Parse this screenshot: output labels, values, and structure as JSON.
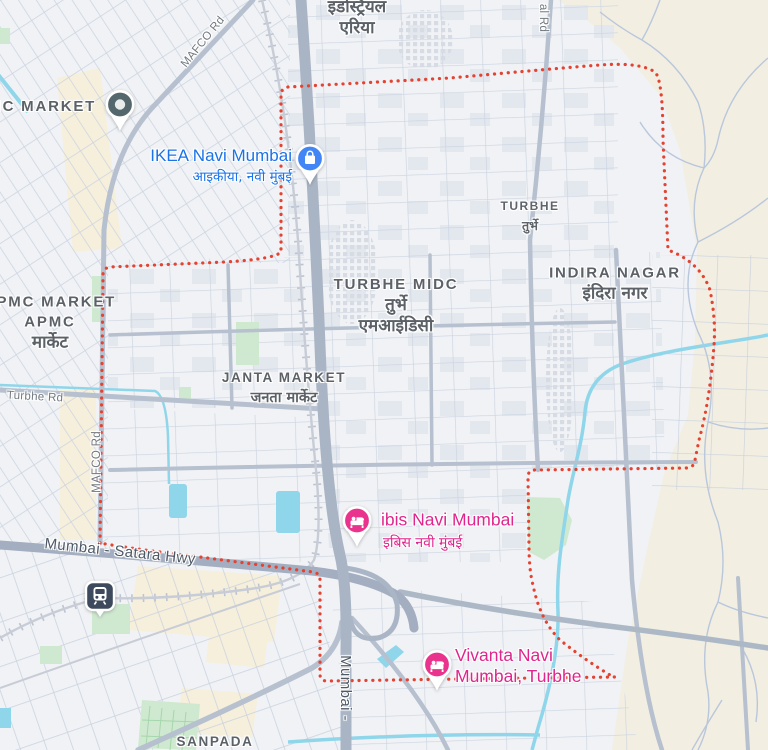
{
  "map": {
    "region": "Turbhe MIDC, Navi Mumbai",
    "colors": {
      "boundary_red": "#e44332",
      "poi_blue": "#4285f4",
      "hotel_pink": "#e9338d",
      "transit_navy": "#3d4a5d",
      "place_pin_slate": "#54676d",
      "water": "#8fd6ea",
      "park_green": "#cfe9d0",
      "terrain_beige": "#f2eee2",
      "label_gray": "#5c6167",
      "poi_label_blue": "#1a73e8",
      "poi_label_pink": "#e0258c"
    },
    "labels": [
      {
        "name": "label-industrial-area",
        "interactable": false,
        "x": 357,
        "y": 18,
        "lines": [
          {
            "t": "इंडस्ट्रियल",
            "c": "hindi-lg"
          },
          {
            "t": "एरिया",
            "c": "hindi-lg"
          }
        ]
      },
      {
        "name": "label-apmc-market-top",
        "interactable": false,
        "x": 30,
        "y": 107,
        "lines": [
          {
            "t": "APMC MARKET",
            "c": "area-lg"
          }
        ]
      },
      {
        "name": "label-ikea-title",
        "interactable": true,
        "align": "right",
        "x": 292,
        "y": 156,
        "lines": [
          {
            "t": "IKEA Navi Mumbai",
            "c": "poi-blue-title"
          }
        ]
      },
      {
        "name": "label-ikea-subtitle",
        "interactable": true,
        "align": "right",
        "x": 292,
        "y": 177,
        "lines": [
          {
            "t": "आइकीया, नवी मुंबई",
            "c": "poi-blue-sub"
          }
        ]
      },
      {
        "name": "label-al-rd",
        "interactable": false,
        "x": 543,
        "y": 18,
        "rot": 90,
        "lines": [
          {
            "t": "al Rd",
            "c": "road"
          }
        ]
      },
      {
        "name": "label-turbhe-locality",
        "interactable": false,
        "x": 530,
        "y": 216,
        "lines": [
          {
            "t": "TURBHE",
            "c": "area-sm"
          },
          {
            "t": "तुर्भे",
            "c": "hindi-sm"
          }
        ]
      },
      {
        "name": "label-apmc-market",
        "interactable": false,
        "x": 50,
        "y": 323,
        "lines": [
          {
            "t": "APMC MARKET",
            "c": "area-lg"
          },
          {
            "t": "APMC",
            "c": "area-lg"
          },
          {
            "t": "मार्केट",
            "c": "hindi-lg"
          }
        ]
      },
      {
        "name": "label-turbhe-midc",
        "interactable": false,
        "x": 396,
        "y": 306,
        "lines": [
          {
            "t": "TURBHE MIDC",
            "c": "area-lg"
          },
          {
            "t": "तुर्भे",
            "c": "hindi-lg"
          },
          {
            "t": "एमआईडिसी",
            "c": "hindi-lg"
          }
        ]
      },
      {
        "name": "label-indira-nagar",
        "interactable": false,
        "x": 615,
        "y": 284,
        "lines": [
          {
            "t": "INDIRA NAGAR",
            "c": "area-lg"
          },
          {
            "t": "इंदिरा नगर",
            "c": "hindi-lg"
          }
        ]
      },
      {
        "name": "label-janta-market",
        "interactable": false,
        "x": 284,
        "y": 388,
        "lines": [
          {
            "t": "JANTA MARKET",
            "c": "area-md"
          },
          {
            "t": "जनता मार्केट",
            "c": "hindi-md"
          }
        ]
      },
      {
        "name": "label-turbhe-rd",
        "interactable": false,
        "x": 35,
        "y": 397,
        "rot": 3,
        "lines": [
          {
            "t": "Turbhe Rd",
            "c": "road"
          }
        ]
      },
      {
        "name": "label-mafco-rd-diagonal",
        "interactable": false,
        "x": 203,
        "y": 42,
        "rot": -51,
        "lines": [
          {
            "t": "MAFCO Rd",
            "c": "road"
          }
        ]
      },
      {
        "name": "label-mafco-rd-vertical",
        "interactable": false,
        "x": 97,
        "y": 462,
        "rot": -90,
        "lines": [
          {
            "t": "MAFCO Rd",
            "c": "road"
          }
        ]
      },
      {
        "name": "label-mumbai-satara-hwy",
        "interactable": false,
        "x": 120,
        "y": 552,
        "rot": 6,
        "lines": [
          {
            "t": "Mumbai - Satara Hwy",
            "c": "road-lg"
          }
        ]
      },
      {
        "name": "label-ibis-title",
        "interactable": true,
        "align": "left",
        "x": 381,
        "y": 520,
        "lines": [
          {
            "t": "ibis Navi Mumbai",
            "c": "poi-pink-title"
          }
        ]
      },
      {
        "name": "label-ibis-subtitle",
        "interactable": true,
        "align": "left",
        "x": 383,
        "y": 543,
        "lines": [
          {
            "t": "इबिस नवी मुंबई",
            "c": "poi-pink-sub"
          }
        ]
      },
      {
        "name": "label-vivanta",
        "interactable": true,
        "align": "left",
        "x": 455,
        "y": 666,
        "lines": [
          {
            "t": "Vivanta Navi",
            "c": "poi-pink-title"
          },
          {
            "t": "Mumbai, Turbhe",
            "c": "poi-pink-title"
          }
        ]
      },
      {
        "name": "label-sanpada",
        "interactable": false,
        "x": 215,
        "y": 742,
        "lines": [
          {
            "t": "SANPADA",
            "c": "area-md"
          }
        ]
      },
      {
        "name": "label-mumbai-vertical",
        "interactable": false,
        "x": 345,
        "y": 688,
        "rot": 90,
        "lines": [
          {
            "t": "Mumbai -",
            "c": "road-lg"
          }
        ]
      }
    ],
    "markers": [
      {
        "name": "marker-apmc-place-pin",
        "icon": "place-pin",
        "x": 120,
        "y": 105,
        "color": "#54676d"
      },
      {
        "name": "marker-ikea-shopping-pin",
        "icon": "shopping-pin",
        "x": 310,
        "y": 159,
        "color": "#4285f4"
      },
      {
        "name": "marker-ibis-hotel-pin",
        "icon": "hotel-pin",
        "x": 357,
        "y": 521,
        "color": "#e9338d"
      },
      {
        "name": "marker-vivanta-hotel-pin",
        "icon": "hotel-pin",
        "x": 437,
        "y": 665,
        "color": "#e9338d"
      },
      {
        "name": "marker-turbhe-station",
        "icon": "transit-badge",
        "x": 100,
        "y": 596,
        "color": "#3d4a5d"
      }
    ]
  }
}
